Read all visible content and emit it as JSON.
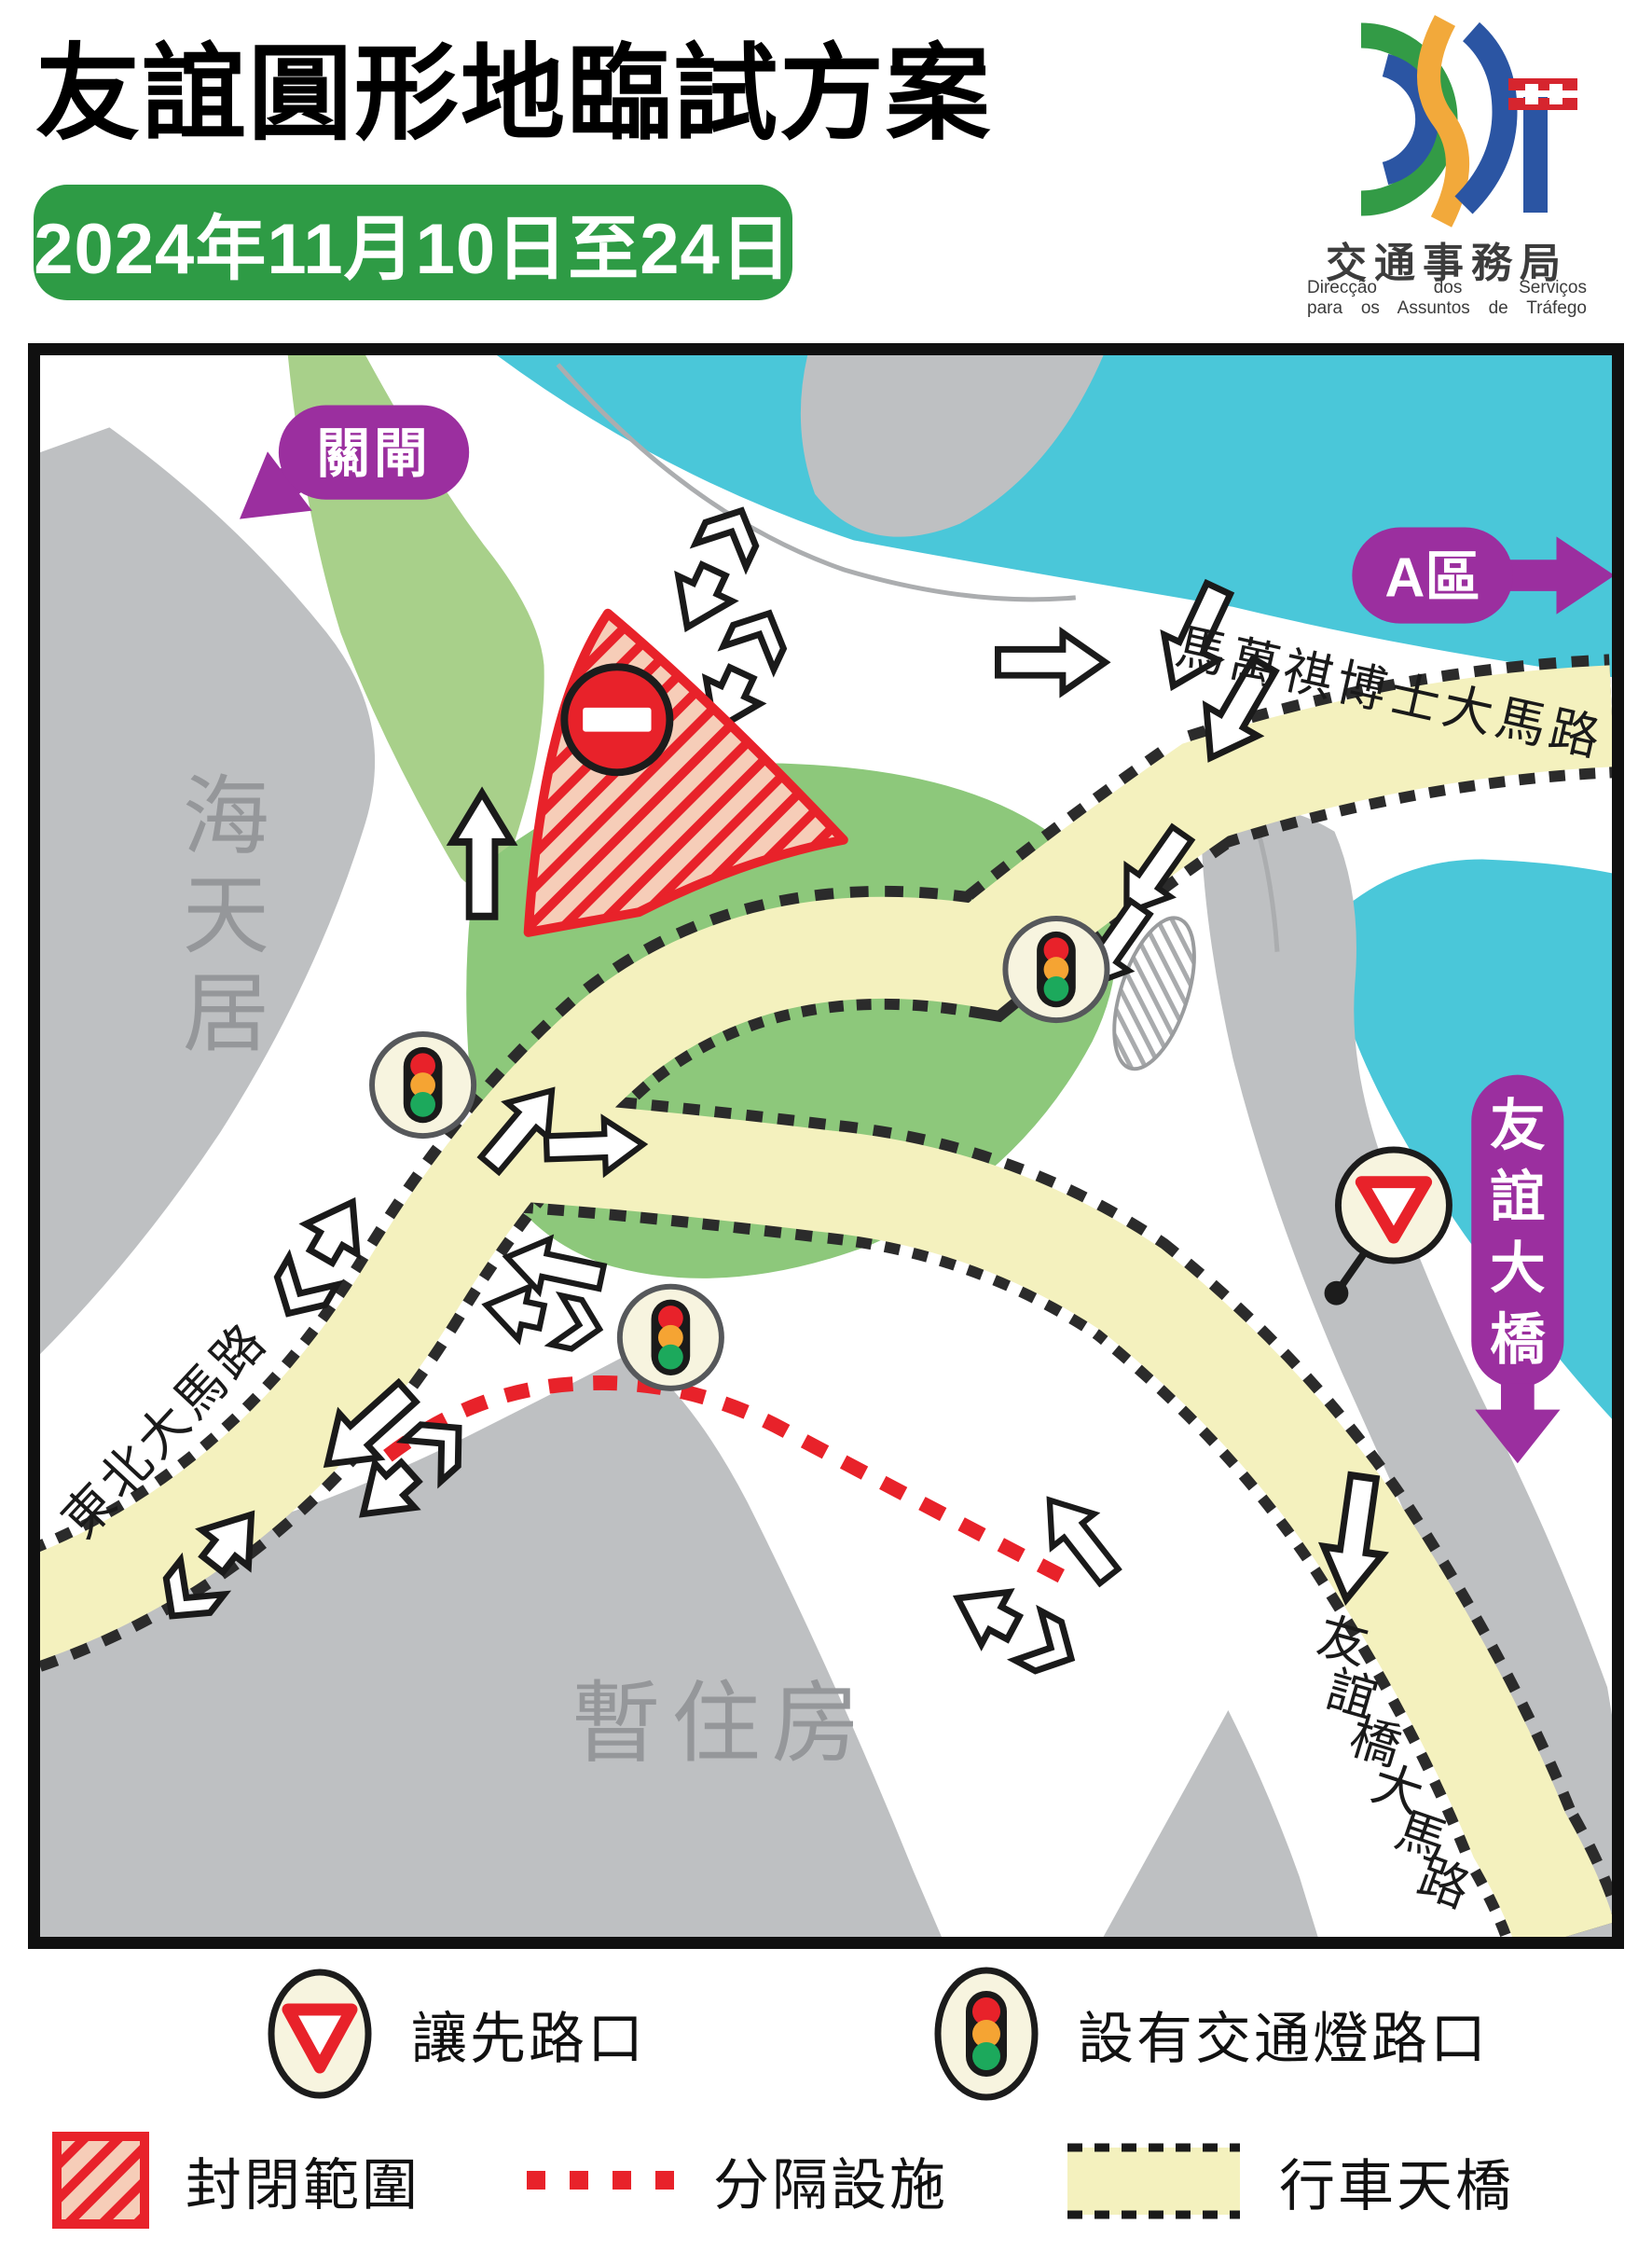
{
  "header": {
    "title": "友誼圓形地臨試方案",
    "date_banner": "2024年11月10日至24日"
  },
  "logo": {
    "agency_cn": "交通事務局",
    "agency_pt_line1": "Direcção dos Serviços",
    "agency_pt_line2": "para os Assuntos de Tráfego"
  },
  "map": {
    "labels": {
      "gate": "關閘",
      "zone_a": "A區",
      "bridge_c0": "友",
      "bridge_c1": "誼",
      "bridge_c2": "大",
      "bridge_c3": "橋",
      "htj_c0": "海",
      "htj_c1": "天",
      "htj_c2": "居",
      "temp_housing": "暫住房",
      "road_mwk": "馬萬祺博士大馬路",
      "road_ne": "東北大馬路",
      "fb_c0": "友",
      "fb_c1": "誼",
      "fb_c2": "橋",
      "fb_c3": "大",
      "fb_c4": "馬",
      "fb_c5": "路"
    }
  },
  "legend": {
    "yield_label": "讓先路口",
    "signal_label": "設有交通燈路口",
    "closed_label": "封閉範圍",
    "divider_label": "分隔設施",
    "flyover_label": "行車天橋"
  },
  "colors": {
    "banner_green": "#2E9B45",
    "water_cyan": "#4AC7D9",
    "building_gray": "#BEC0C2",
    "roundabout_green": "#8DC87B",
    "flyover_yellow": "#F4F1BE",
    "purple": "#9B2F9F",
    "red": "#E8222A"
  }
}
